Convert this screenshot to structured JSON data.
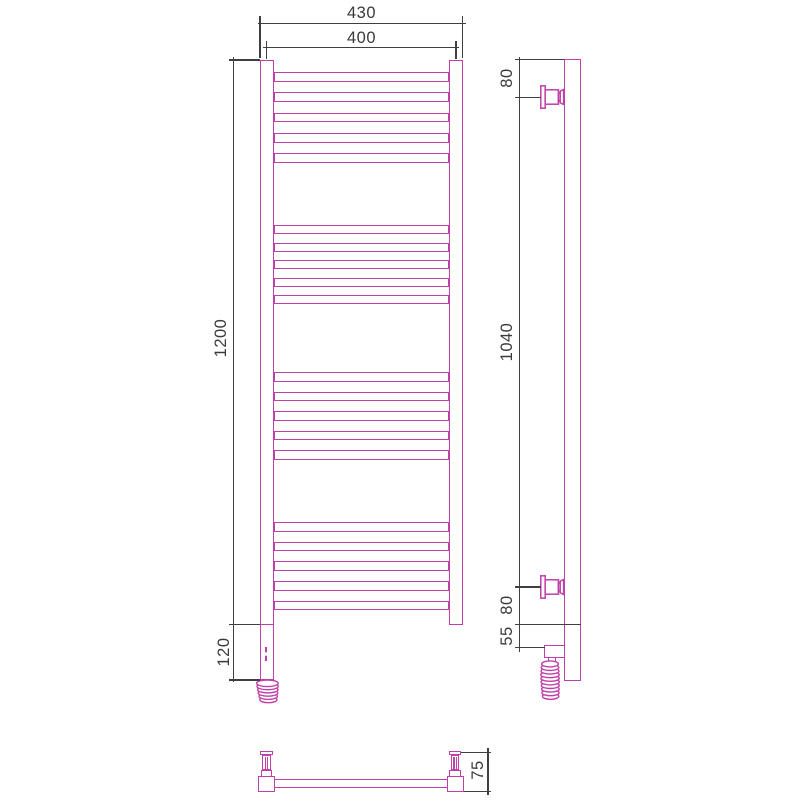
{
  "title": "Heated towel rail — dimensional drawing (front, side and bottom views)",
  "colors": {
    "product": "#c13fa8",
    "dimension": "#3f3f3f",
    "background": "#ffffff"
  },
  "views": {
    "front": {
      "labels": {
        "overall_width": "430",
        "mounting_width": "400",
        "rail_height": "1200",
        "heater_section_height": "120"
      },
      "rung_groups": 4,
      "rungs_per_group": 5
    },
    "side": {
      "labels": {
        "top_bracket_offset": "80",
        "bracket_spacing": "1040",
        "bottom_bracket_offset": "80",
        "heater_offset": "55"
      }
    },
    "bottom": {
      "labels": {
        "depth": "75"
      }
    }
  }
}
